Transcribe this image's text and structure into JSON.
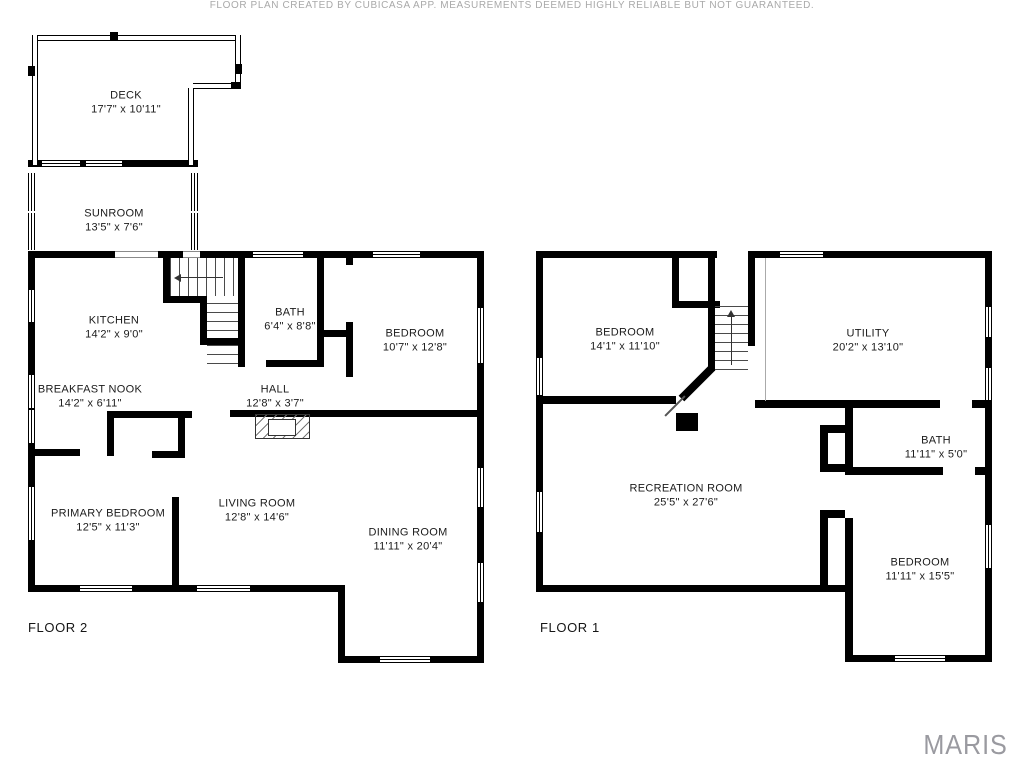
{
  "floors": [
    {
      "label": "FLOOR 2",
      "rooms": [
        {
          "name": "DECK",
          "dims": "17'7\" x 10'11\""
        },
        {
          "name": "SUNROOM",
          "dims": "13'5\" x 7'6\""
        },
        {
          "name": "KITCHEN",
          "dims": "14'2\" x 9'0\""
        },
        {
          "name": "BATH",
          "dims": "6'4\" x 8'8\""
        },
        {
          "name": "BEDROOM",
          "dims": "10'7\" x 12'8\""
        },
        {
          "name": "BREAKFAST NOOK",
          "dims": "14'2\" x 6'11\""
        },
        {
          "name": "HALL",
          "dims": "12'8\" x 3'7\""
        },
        {
          "name": "PRIMARY BEDROOM",
          "dims": "12'5\" x 11'3\""
        },
        {
          "name": "LIVING ROOM",
          "dims": "12'8\" x 14'6\""
        },
        {
          "name": "DINING ROOM",
          "dims": "11'11\" x 20'4\""
        }
      ]
    },
    {
      "label": "FLOOR 1",
      "rooms": [
        {
          "name": "BEDROOM",
          "dims": "14'1\" x 11'10\""
        },
        {
          "name": "UTILITY",
          "dims": "20'2\" x 13'10\""
        },
        {
          "name": "RECREATION ROOM",
          "dims": "25'5\" x 27'6\""
        },
        {
          "name": "BATH",
          "dims": "11'11\" x 5'0\""
        },
        {
          "name": "BEDROOM",
          "dims": "11'11\" x 15'5\""
        }
      ]
    }
  ],
  "footer": {
    "disclaimer": "FLOOR PLAN CREATED BY CUBICASA APP. MEASUREMENTS DEEMED HIGHLY RELIABLE BUT NOT GUARANTEED.",
    "brand": "MARIS"
  },
  "colors": {
    "wall": "#000000",
    "label_text": "#1b1b1b",
    "footer_text": "#a9a9a9",
    "brand_text": "#9a9aa0"
  }
}
